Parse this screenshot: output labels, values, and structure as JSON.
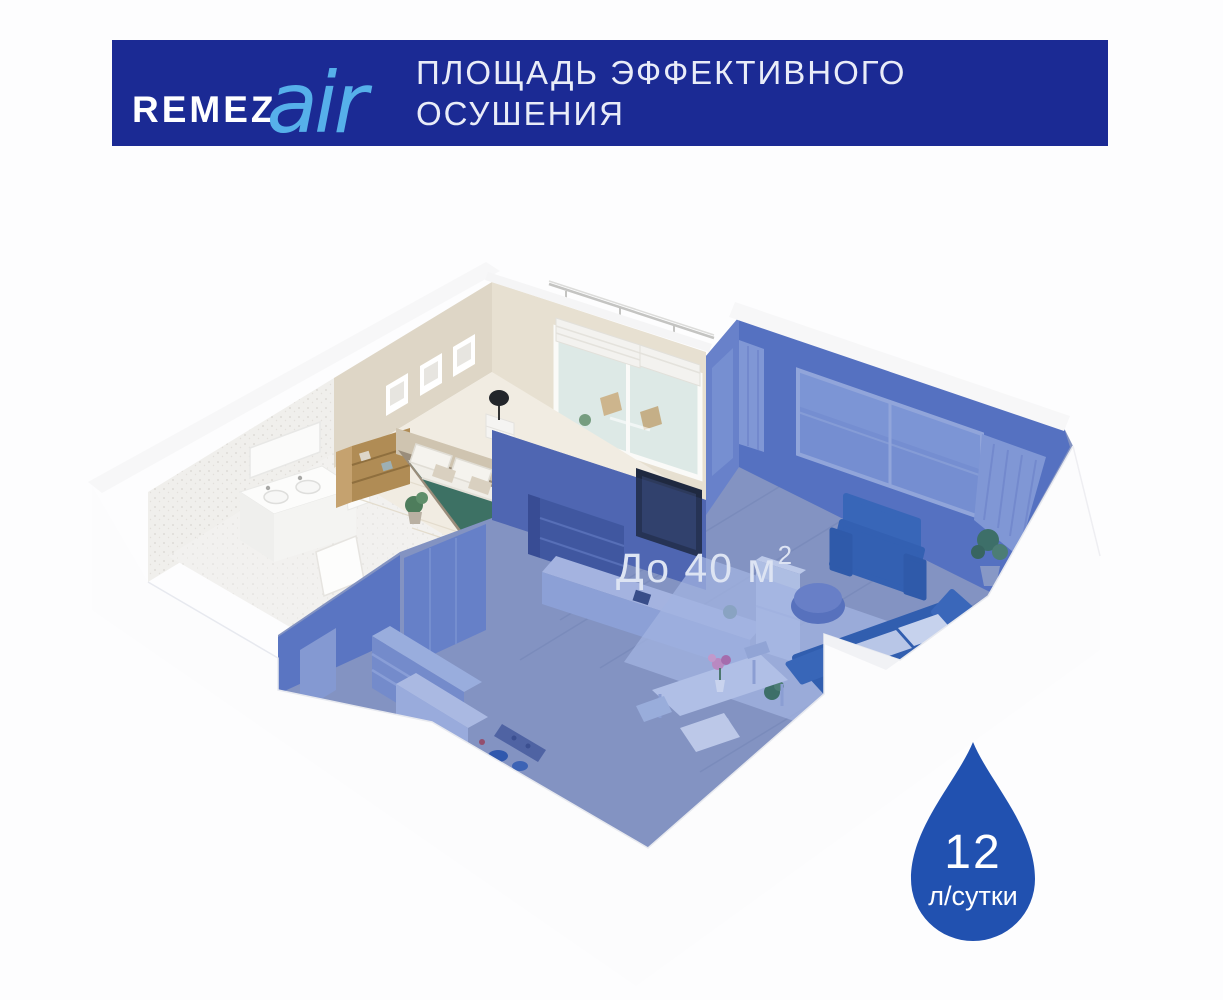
{
  "header": {
    "brand_name": "REMEZ",
    "brand_suffix": "air",
    "title_line1": "ПЛОЩАДЬ ЭФФЕКТИВНОГО",
    "title_line2": "ОСУШЕНИЯ"
  },
  "colors": {
    "banner": "#1b2a94",
    "brand_suffix": "#56b0ea",
    "highlight_zone": "#4868c4",
    "drop_badge": "#2151b0"
  },
  "floorplan": {
    "area_label": "До 40 м",
    "area_label_superscript": "2"
  },
  "capacity_badge": {
    "icon": "water-drop-icon",
    "value": "12",
    "unit": "л/сутки"
  }
}
